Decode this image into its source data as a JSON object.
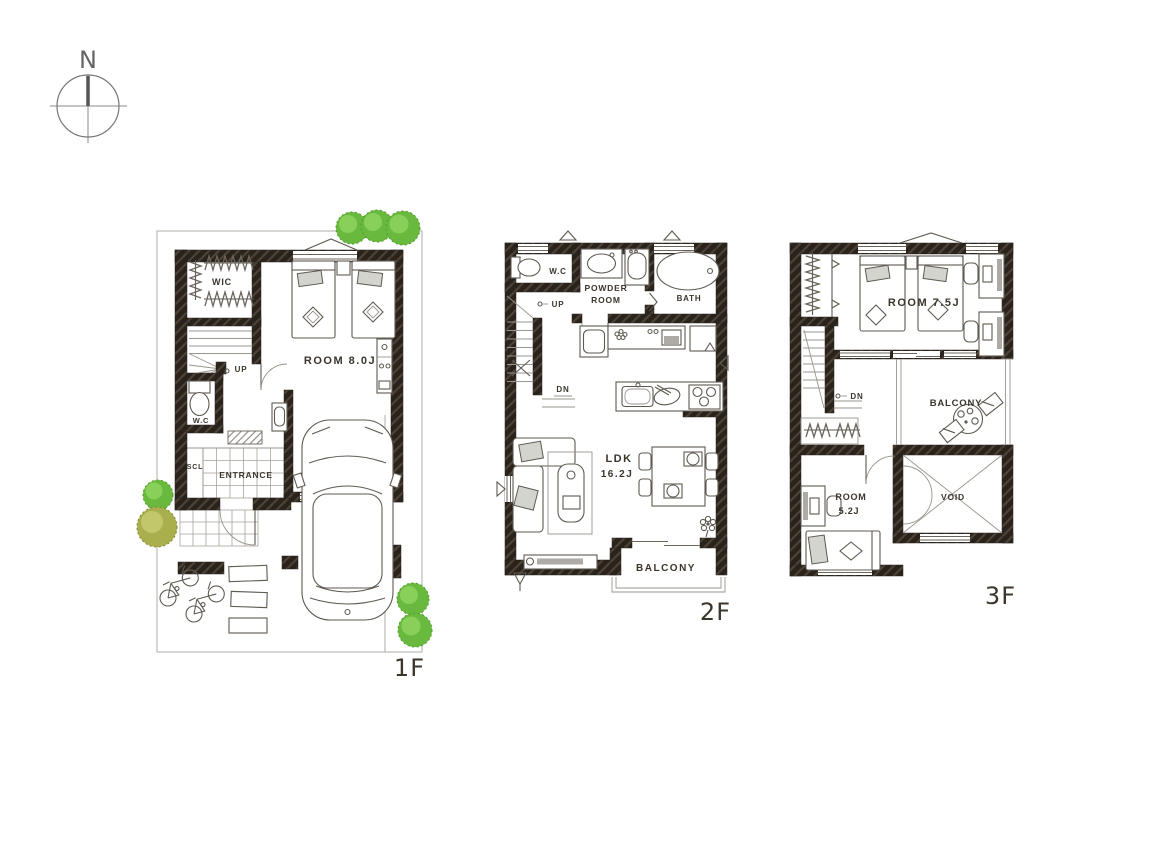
{
  "palette": {
    "wall": "#29231c",
    "wall_hatch": "#4d4337",
    "furniture_line": "#5f5a52",
    "faint_line": "#b8b4ae",
    "text": "#3b352c",
    "tree_green": "#69b93e",
    "tree_green_light": "#8fd45f",
    "tree_olive": "#a9af4c",
    "tree_olive_light": "#c6cc71",
    "pillow_gray": "#d4d4ce"
  },
  "compass": {
    "north": "N"
  },
  "floor1": {
    "label": "1F",
    "wic": "WIC",
    "room": "ROOM 8.0J",
    "up": "UP",
    "wc": "W.C",
    "scl": "SCL",
    "entrance": "ENTRANCE"
  },
  "floor2": {
    "label": "2F",
    "wc": "W.C",
    "powder_line1": "POWDER",
    "powder_line2": "ROOM",
    "bath": "BATH",
    "up": "UP",
    "dn": "DN",
    "ldk_line1": "LDK",
    "ldk_line2": "16.2J",
    "balcony": "BALCONY"
  },
  "floor3": {
    "label": "3F",
    "room_a": "ROOM 7.5J",
    "dn": "DN",
    "balcony": "BALCONY",
    "room_b_line1": "ROOM",
    "room_b_line2": "5.2J",
    "void": "VOID"
  }
}
